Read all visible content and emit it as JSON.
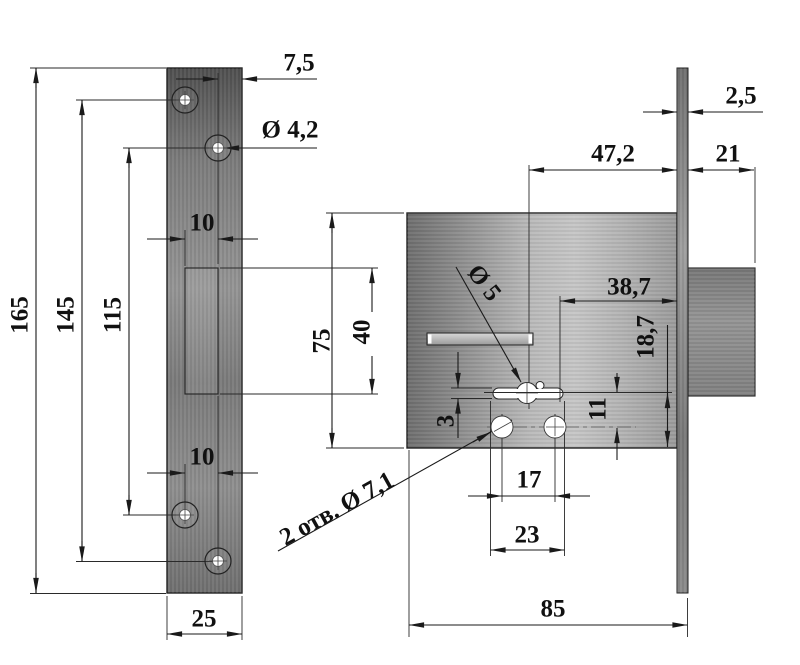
{
  "drawing": {
    "title": "Mortise lock technical drawing",
    "strike_plate": {
      "dim_total_height": "165",
      "dim_hole_span_outer": "145",
      "dim_hole_span_inner": "115",
      "dim_edge_to_hole": "7,5",
      "dim_hole_diameter": "Ø 4,2",
      "dim_hole_offset_top": "10",
      "dim_slot_height": "40",
      "dim_hole_offset_bottom": "10",
      "dim_plate_width": "25"
    },
    "lock_body": {
      "dim_faceplate_thickness": "2,5",
      "dim_backset": "47,2",
      "dim_bolt_throw": "21",
      "dim_keyhole_to_face": "38,7",
      "dim_body_height": "75",
      "dim_keyhole_to_bottom": "18,7",
      "dim_keyhole_to_holes": "11",
      "dim_keyhole_slot_width": "3",
      "dim_holes_spacing": "17",
      "dim_keyhole_length": "23",
      "dim_body_depth": "85",
      "label_key_shaft_diameter": "Ø 5",
      "label_fixing_holes": "2 отв. Ø 7,1"
    },
    "colors": {
      "background": "#ffffff",
      "line": "#1a1a1a",
      "label": "#111111",
      "metal_dark": "#555555",
      "metal_mid": "#8f8f8f",
      "metal_light": "#c6c6c6"
    }
  }
}
